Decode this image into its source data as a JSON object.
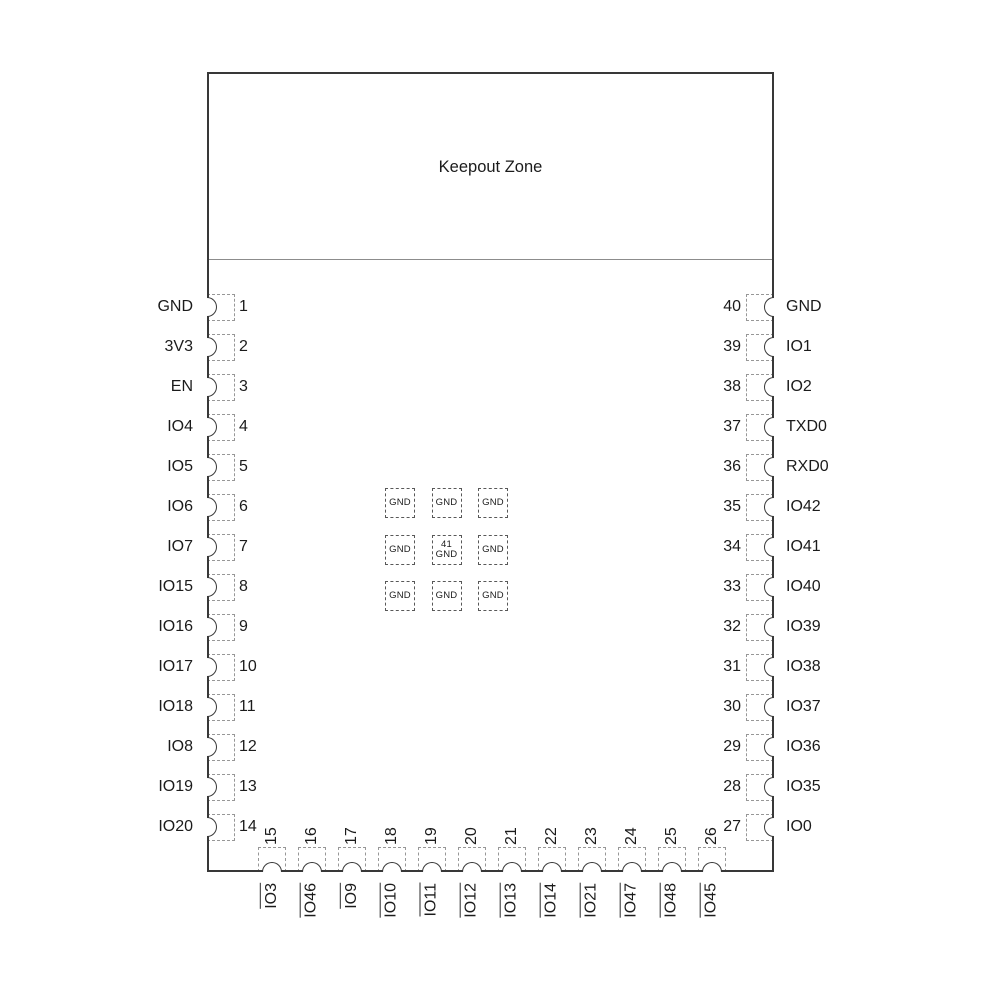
{
  "keepout_label": "Keepout Zone",
  "colors": {
    "background": "#ffffff",
    "module_outline": "#383838",
    "keepout_line": "#8c8c8c",
    "pin_pad_dash": "#979797",
    "gnd_pad_dash": "#585858",
    "text": "#1b1b1b"
  },
  "left_pins": [
    {
      "num": "1",
      "label": "GND"
    },
    {
      "num": "2",
      "label": "3V3"
    },
    {
      "num": "3",
      "label": "EN"
    },
    {
      "num": "4",
      "label": "IO4"
    },
    {
      "num": "5",
      "label": "IO5"
    },
    {
      "num": "6",
      "label": "IO6"
    },
    {
      "num": "7",
      "label": "IO7"
    },
    {
      "num": "8",
      "label": "IO15"
    },
    {
      "num": "9",
      "label": "IO16"
    },
    {
      "num": "10",
      "label": "IO17"
    },
    {
      "num": "11",
      "label": "IO18"
    },
    {
      "num": "12",
      "label": "IO8"
    },
    {
      "num": "13",
      "label": "IO19"
    },
    {
      "num": "14",
      "label": "IO20"
    }
  ],
  "right_pins": [
    {
      "num": "40",
      "label": "GND"
    },
    {
      "num": "39",
      "label": "IO1"
    },
    {
      "num": "38",
      "label": "IO2"
    },
    {
      "num": "37",
      "label": "TXD0"
    },
    {
      "num": "36",
      "label": "RXD0"
    },
    {
      "num": "35",
      "label": "IO42"
    },
    {
      "num": "34",
      "label": "IO41"
    },
    {
      "num": "33",
      "label": "IO40"
    },
    {
      "num": "32",
      "label": "IO39"
    },
    {
      "num": "31",
      "label": "IO38"
    },
    {
      "num": "30",
      "label": "IO37"
    },
    {
      "num": "29",
      "label": "IO36"
    },
    {
      "num": "28",
      "label": "IO35"
    },
    {
      "num": "27",
      "label": "IO0"
    }
  ],
  "bottom_pins": [
    {
      "num": "15",
      "label": "IO3"
    },
    {
      "num": "16",
      "label": "IO46"
    },
    {
      "num": "17",
      "label": "IO9"
    },
    {
      "num": "18",
      "label": "IO10"
    },
    {
      "num": "19",
      "label": "IO11"
    },
    {
      "num": "20",
      "label": "IO12"
    },
    {
      "num": "21",
      "label": "IO13"
    },
    {
      "num": "22",
      "label": "IO14"
    },
    {
      "num": "23",
      "label": "IO21"
    },
    {
      "num": "24",
      "label": "IO47"
    },
    {
      "num": "25",
      "label": "IO48"
    },
    {
      "num": "26",
      "label": "IO45"
    }
  ],
  "center_pads": [
    {
      "label": "GND"
    },
    {
      "label": "GND"
    },
    {
      "label": "GND"
    },
    {
      "label": "GND"
    },
    {
      "num": "41",
      "label": "GND"
    },
    {
      "label": "GND"
    },
    {
      "label": "GND"
    },
    {
      "label": "GND"
    },
    {
      "label": "GND"
    }
  ]
}
